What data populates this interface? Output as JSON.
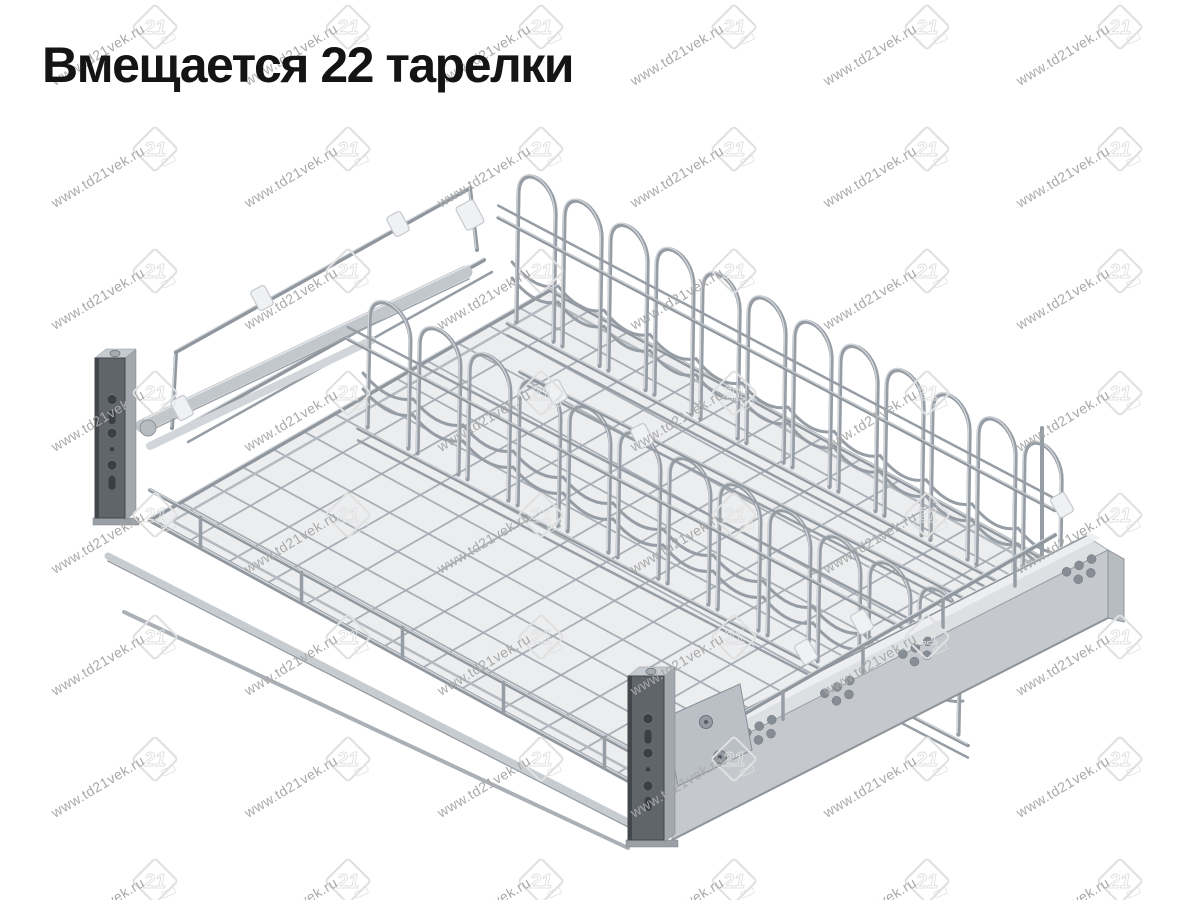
{
  "caption": "Вмещается 22 тарелки",
  "capacity_plates": 22,
  "watermark": {
    "url_text": "www.td21vek.ru",
    "logo_text": "21",
    "text_color": "#a9a9a9",
    "logo_color": "#e0e0e0",
    "text_angle_deg": -31,
    "text_font_size": 14,
    "grid": {
      "step_x": 193,
      "step_y": 122,
      "cols": 7,
      "rows": 8,
      "logo_x": 155,
      "logo_y": 27,
      "text_x": 55,
      "text_y": 86
    }
  },
  "product": {
    "name": "pull-out wire dish drying rack",
    "sections": 2,
    "arcs_per_row": 12,
    "mesh_lines": 12,
    "palette": {
      "wire": "#969da5",
      "wire_dark": "#8f969d",
      "wire_light": "#d8dcdf",
      "mesh": "#a6acb3",
      "mesh_fill": "#e7e9eb",
      "bracket_face": "#60656b",
      "bracket_edge": "#43474c",
      "bracket_side": "#a2a8ae",
      "bracket_cap": "#c6cbd0",
      "hole": "#3b3f44",
      "slide_top": "#dde0e3",
      "slide_face": "#c5c9ce",
      "slide_edge": "#8d9399",
      "slide_hole": "#868d94",
      "clip": "#f0f1f3",
      "clip_edge": "#c6cace",
      "bar": "#c2c7cb"
    }
  }
}
